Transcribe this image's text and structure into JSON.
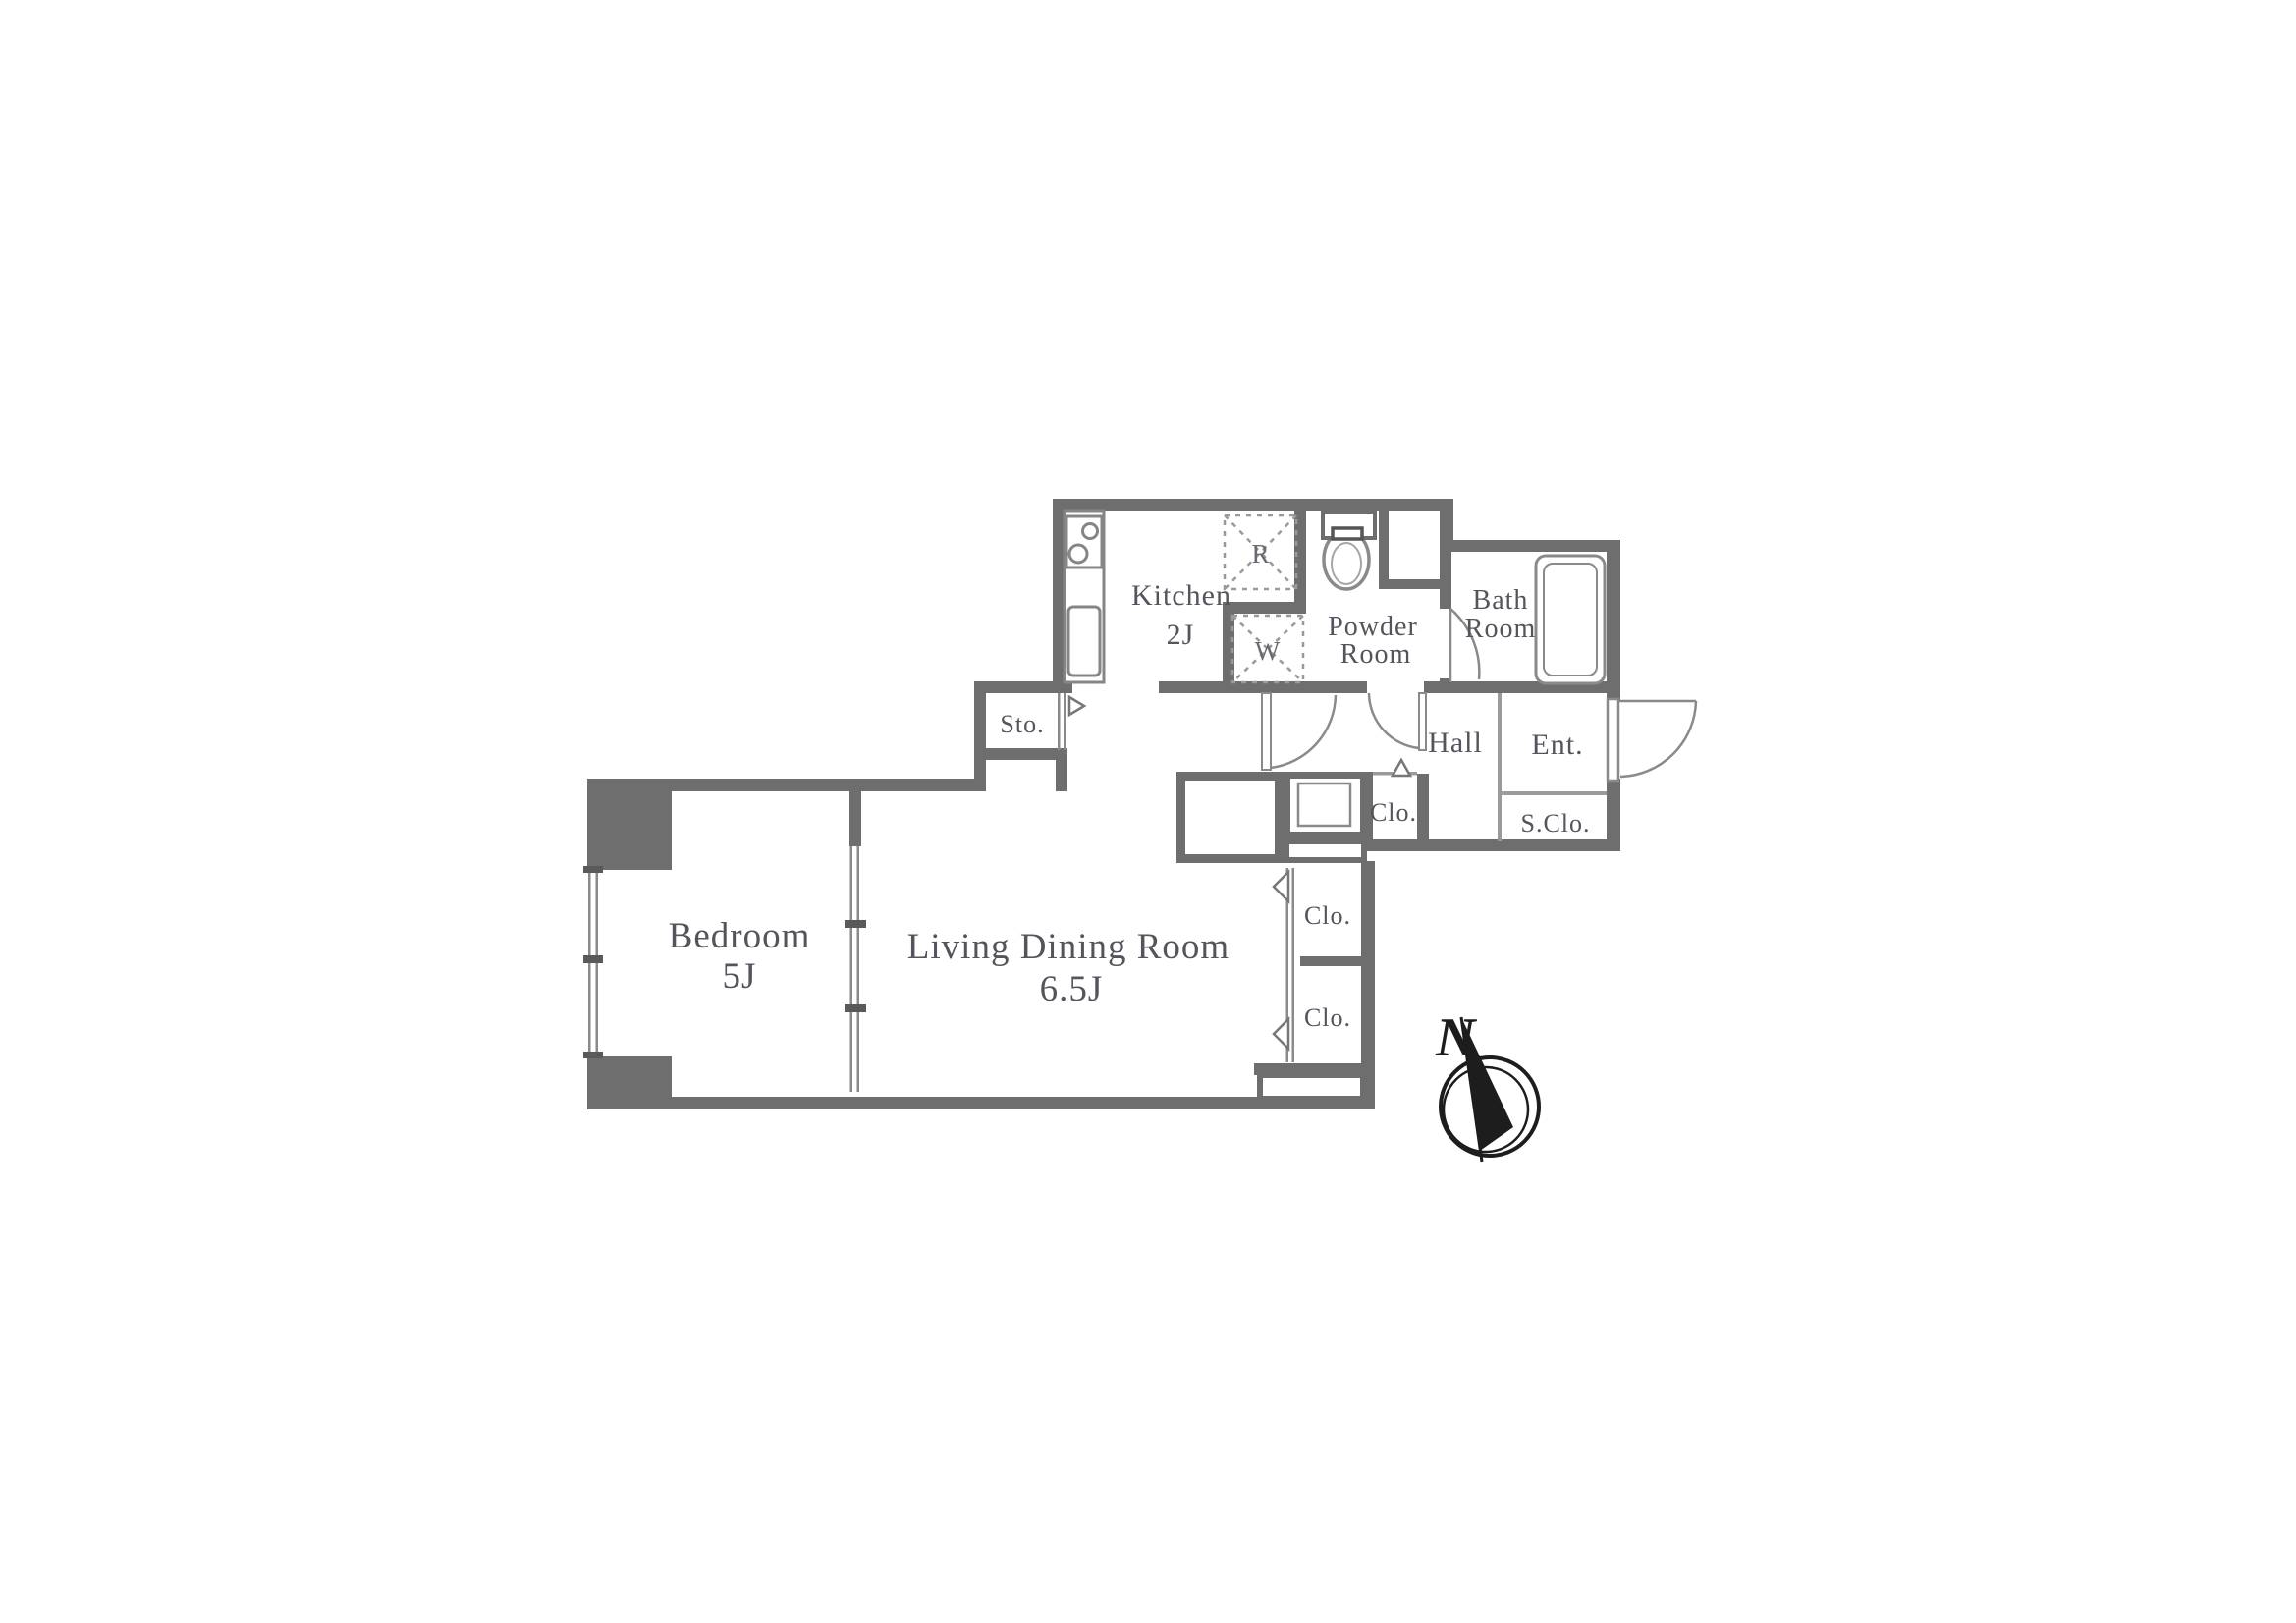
{
  "rooms": {
    "bedroom": {
      "name": "Bedroom",
      "area": "5J"
    },
    "living_dining": {
      "name": "Living Dining Room",
      "area": "6.5J"
    },
    "kitchen": {
      "name": "Kitchen",
      "area": "2J"
    },
    "powder_room": {
      "line1": "Powder",
      "line2": "Room"
    },
    "bath_room": {
      "line1": "Bath",
      "line2": "Room"
    },
    "hall": {
      "name": "Hall"
    },
    "entrance": {
      "name": "Ent."
    },
    "shoe_closet": {
      "name": "S.Clo."
    },
    "hall_closet": {
      "name": "Clo."
    },
    "closet_upper": {
      "name": "Clo."
    },
    "closet_lower": {
      "name": "Clo."
    },
    "storage": {
      "name": "Sto."
    }
  },
  "appliances": {
    "refrigerator_mark": "R",
    "washer_mark": "W"
  },
  "compass": {
    "north_label": "N"
  },
  "colors": {
    "wall": "#6e6e6e",
    "thin_line": "#8a8a8a",
    "fixture_line": "#919191",
    "text": "#54545c",
    "compass": "#1d1d1d",
    "background": "#ffffff"
  }
}
